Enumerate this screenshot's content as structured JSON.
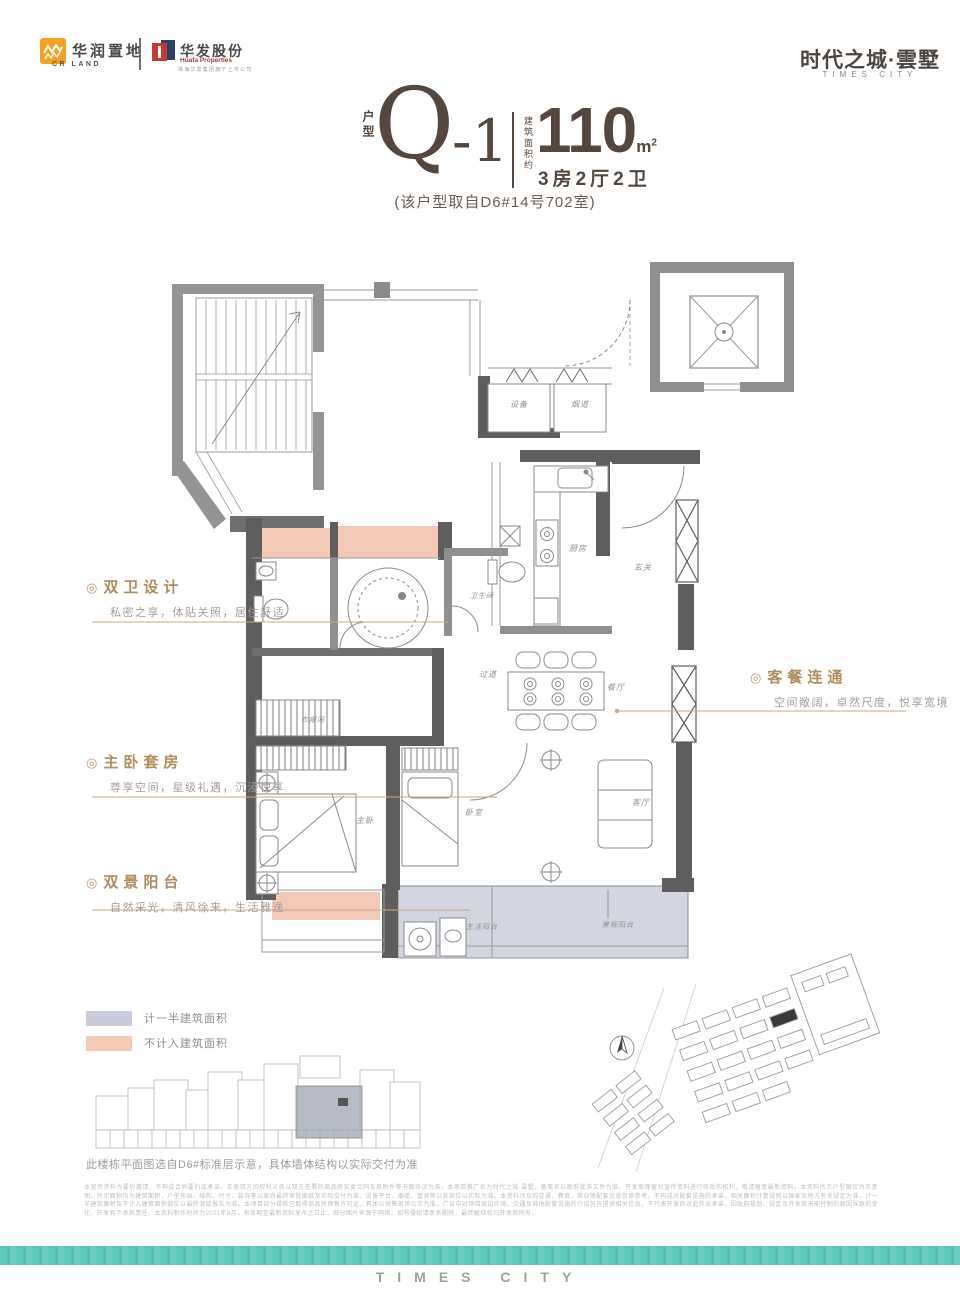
{
  "brand_bar": {
    "crland": {
      "name_cn": "华润置地",
      "name_en": "CR LAND"
    },
    "huafa": {
      "name_cn": "华发股份",
      "name_en": "Huafa Properties",
      "tagline": "珠海华发集团旗下上市公司"
    },
    "project": {
      "name_cn": "时代之城·雲墅",
      "name_en": "TIMES CITY"
    }
  },
  "unit_header": {
    "type_label": "户型",
    "code": "Q",
    "code_suffix": "-1",
    "area_label": "建筑面积约",
    "area_value": "110",
    "area_unit_base": "m",
    "area_unit_sup": "2",
    "rooms": "3房2厅2卫",
    "source": "(该户型取自D6#14号702室)"
  },
  "annotations": {
    "left": [
      {
        "bullet": "◎",
        "title": "双卫设计",
        "desc": "私密之享，体贴关照，居住舒适"
      },
      {
        "bullet": "◎",
        "title": "主卧套房",
        "desc": "尊享空间，星级礼遇，沉浸悦享"
      },
      {
        "bullet": "◎",
        "title": "双景阳台",
        "desc": "自然采光，清风徐来，生活雅逸"
      }
    ],
    "right": [
      {
        "bullet": "◎",
        "title": "客餐连通",
        "desc": "空间敞阔，卓然尺度，悦享宽境"
      }
    ]
  },
  "floorplan": {
    "rooms": [
      {
        "id": "equipment",
        "label": "设备"
      },
      {
        "id": "flue",
        "label": "烟道"
      },
      {
        "id": "kitchen",
        "label": "厨房"
      },
      {
        "id": "entry",
        "label": "玄关"
      },
      {
        "id": "bathroom",
        "label": "卫生间"
      },
      {
        "id": "dining",
        "label": "餐厅"
      },
      {
        "id": "hallway",
        "label": "过道"
      },
      {
        "id": "living",
        "label": "客厅"
      },
      {
        "id": "cloakroom",
        "label": "衣帽间"
      },
      {
        "id": "master-bedroom",
        "label": "主卧"
      },
      {
        "id": "bedroom",
        "label": "卧室"
      },
      {
        "id": "service-balcony",
        "label": "生活阳台"
      },
      {
        "id": "view-balcony",
        "label": "景观阳台"
      }
    ]
  },
  "legend": {
    "items": [
      {
        "label": "计一半建筑面积",
        "color": "#c9cada"
      },
      {
        "label": "不计入建筑面积",
        "color": "#f3c9b6"
      }
    ]
  },
  "notes": {
    "building_note": "此楼栋平面图选自D6#标准层示意，具体墙体结构以实际交付为准",
    "disclaimer": "本宣传资料为要约邀请，不构成合同要约或承诺，买卖双方的权利义务以双方签署的商品房买卖合同及其附件等书面协议为准。本项目推广名为时代之城·雲墅，备案名以政府批准文件为准，开发商保留对宣传资料进行修改的权利，敬请留意最新资料。本资料所示户型图仅为示意图，所示面积均为建筑面积，户型布局、结构、尺寸、装饰等以政府最终审批图纸及实际交付为准，设备平台、烟道、管井等公共部位以实际为准。本资料涉及的交通、教育、商业等配套信息仅供参考，不构成对配套设施的承诺，相关面积计算规则以国家及地方有关规定为准，计一半建筑面积及不计入建筑面积部位以最终测绘报告为准。本项目部分楼栋已取得商品房预售许可证，具体以销售现场公示为准。广告中对项目周边环境、交通及其他配套设施的介绍旨在提供相关信息，不代表开发商对此作出承诺，因政府规划、规定及开发商未能控制的原因导致的变化，开发商不承担责任。本资料制作时间为2021年8月，有效期至最新资料发布之日止，部分图片来源于网络，如有侵权请联系删除，最终解释权归开发商所有。"
  },
  "footer": {
    "brand_en": "TIMES CITY"
  },
  "colors": {
    "accent_gold": "#b08d5a",
    "header_text": "#55463e",
    "wall_dark": "#5e5e5e",
    "teal_bar": "#5cc6bc",
    "half_area_fill": "#c9cada",
    "excluded_fill": "#f3c9b6"
  }
}
